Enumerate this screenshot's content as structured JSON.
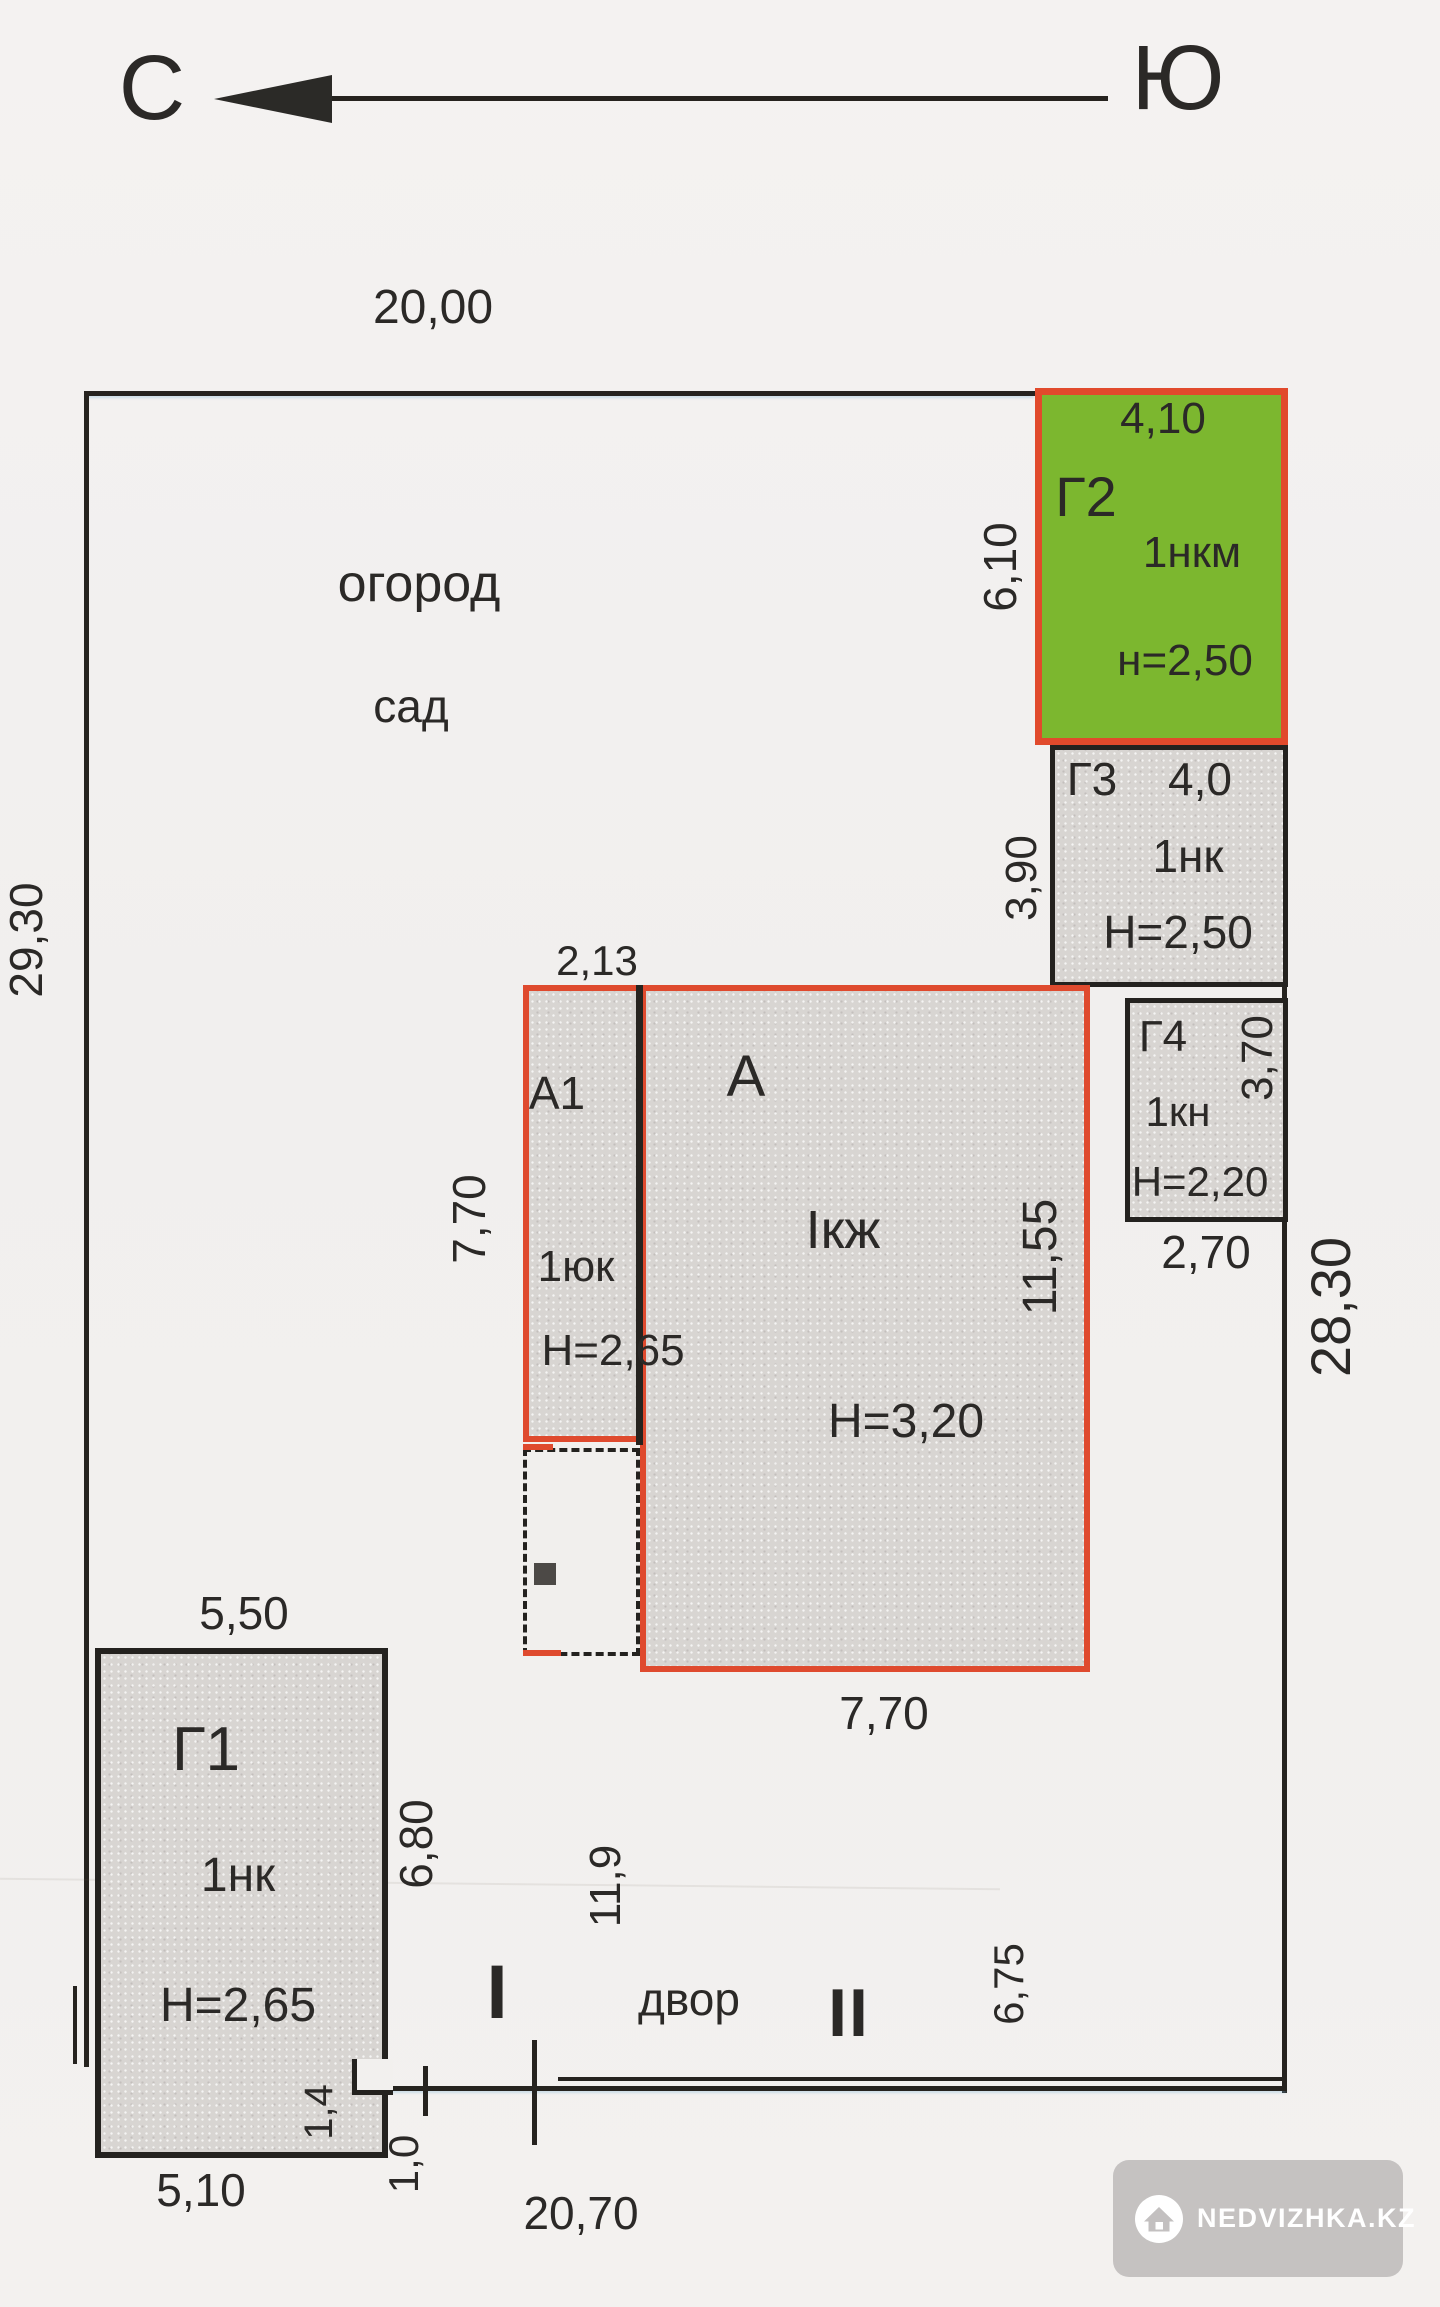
{
  "compass": {
    "north_label": "С",
    "south_label": "Ю"
  },
  "plot": {
    "width_top": "20,00",
    "side_left": "29,30",
    "side_right": "28,30",
    "area_labels": {
      "ogorod": "огород",
      "sad": "сад",
      "dvor": "двор"
    },
    "marks": {
      "gate_i": "I",
      "gate_ii": "II"
    },
    "dims": {
      "gap_left": "1,0",
      "bottom": "20,70",
      "yard_width": "11,9",
      "yard_depth": "6,75"
    }
  },
  "buildings": {
    "g2": {
      "label": "Г2",
      "code": "1нкм",
      "ceiling": "н=2,50",
      "width": "4,10",
      "depth": "6,10",
      "fill": "#7cb72f",
      "border": "#e14a2c"
    },
    "g3": {
      "label": "Г3",
      "width": "4,0",
      "code": "1нк",
      "ceiling": "Н=2,50",
      "depth": "3,90"
    },
    "g4": {
      "label": "Г4",
      "code": "1кн",
      "ceiling": "Н=2,20",
      "depth": "3,70",
      "width": "2,70"
    },
    "a": {
      "label": "А",
      "floors": "Iкж",
      "ceiling": "Н=3,20",
      "depth": "11,55",
      "width": "7,70"
    },
    "a1": {
      "label": "А1",
      "code": "1юк",
      "ceiling": "Н=2,65",
      "width": "2,13",
      "depth": "7,70"
    },
    "g1": {
      "label": "Г1",
      "code": "1нк",
      "ceiling": "Н=2,65",
      "width": "5,50",
      "depth": "6,80",
      "bottom_width": "5,10",
      "notch_depth": "1,4"
    }
  },
  "watermark": {
    "brand": "NEDVIZHKA.KZ"
  }
}
